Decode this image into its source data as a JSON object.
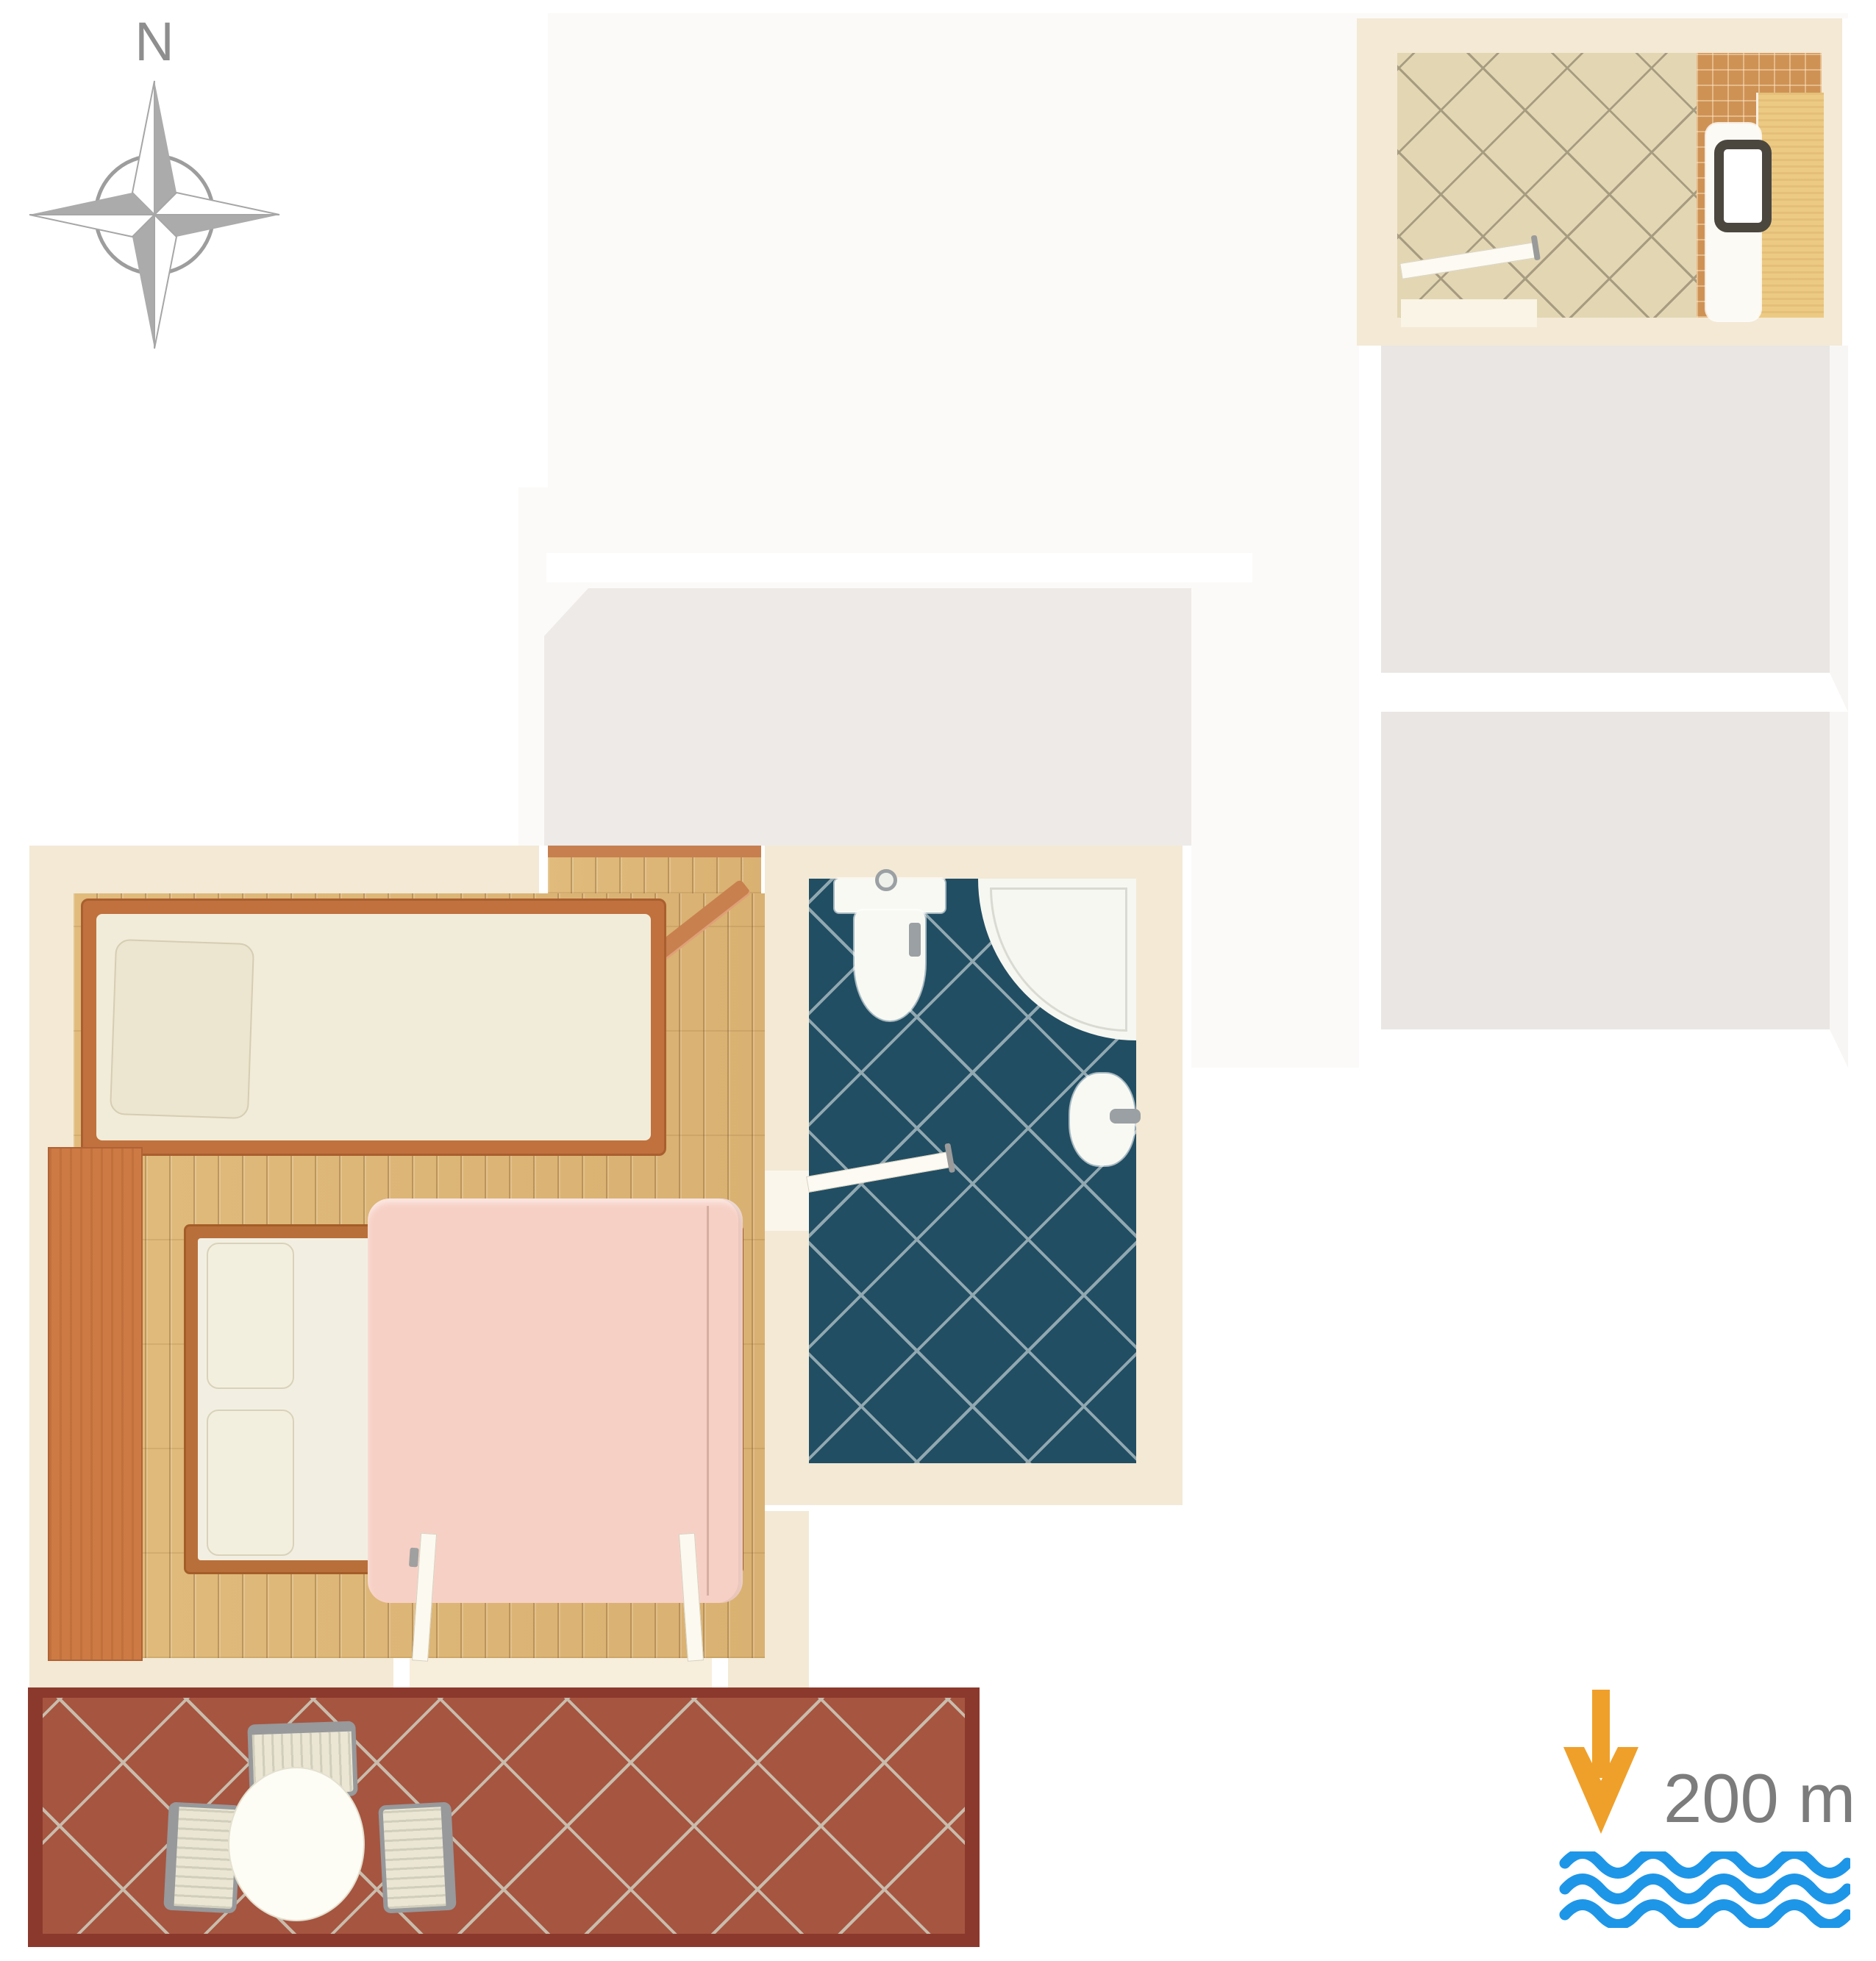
{
  "compass": {
    "label": "N",
    "icon": "compass-rose-icon",
    "star_color": "#ababab",
    "ring_color": "#9d9d9d"
  },
  "sea": {
    "distance_label": "200 m",
    "arrow_icon": "arrow-down-to-sea-icon",
    "waves_icon": "sea-waves-icon",
    "arrow_color": "#efa02a",
    "wave_color": "#1e96e8",
    "text_color": "#7c7c7c"
  },
  "palette": {
    "wall_cream": "#f3e9d5",
    "wood_floor": "#dcb677",
    "bed_frame_wood": "#c0713d",
    "wardrobe_wood": "#cd7a44",
    "blanket_pink": "#f7d0c5",
    "mattress": "#f2efe2",
    "blue_tile": "#224e63",
    "beige_tile": "#e3d6b3",
    "shower_tile_orange": "#cf9255",
    "counter_wood": "#ecca84",
    "terrace_tile": "#a65540",
    "terrace_border": "#8c392d",
    "faded_unit": "#fbfaf8",
    "gray_room": "#e9e6e3",
    "fixture_white": "#f9f9f4",
    "toilet_seat_dark": "#4b473f"
  },
  "rooms": {
    "bedroom": {
      "fixtures": [
        "single-bed",
        "double-bed",
        "wardrobe",
        "entry-door",
        "terrace-double-door"
      ]
    },
    "bathroom": {
      "fixtures": [
        "toilet",
        "corner-shower",
        "bidet",
        "door"
      ]
    },
    "upper_bathroom": {
      "fixtures": [
        "toilet",
        "shower-area",
        "wood-counter",
        "door"
      ]
    },
    "terrace": {
      "fixtures": [
        "round-table",
        "chair-top",
        "chair-left",
        "chair-right"
      ]
    },
    "other_unit": {
      "gray_rooms": 2
    }
  }
}
